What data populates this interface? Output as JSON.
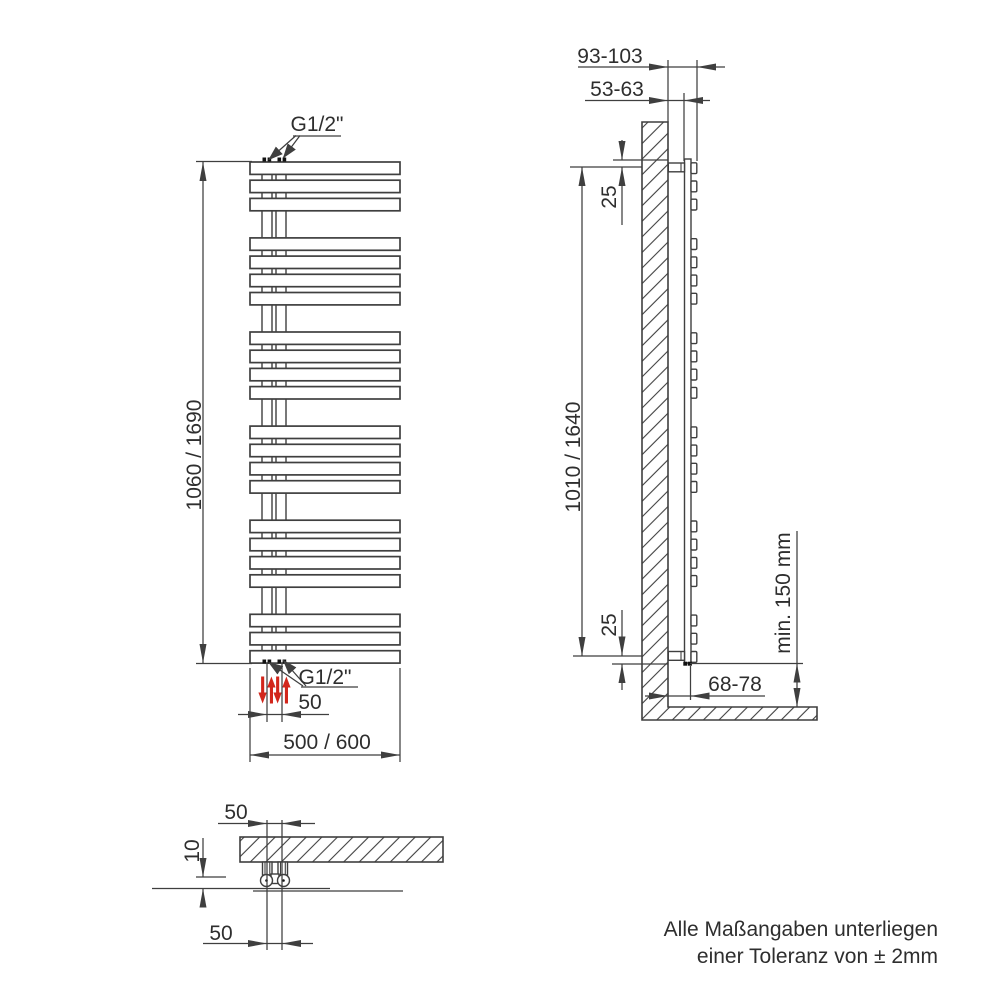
{
  "front_view": {
    "connection_top_label": "G1/2\"",
    "connection_bottom_label": "G1/2\"",
    "height_dim": "1060 / 1690",
    "connection_spacing_dim": "50",
    "width_dim": "500 / 600",
    "bar_groups": [
      3,
      4,
      4,
      4,
      4,
      3
    ]
  },
  "side_view": {
    "total_depth_dim": "93-103",
    "wall_to_tube_dim": "53-63",
    "top_offset_dim": "25",
    "bracket_distance_dim": "1010 / 1640",
    "bottom_offset_dim": "25",
    "floor_clearance_dim": "min. 150 mm",
    "valve_wall_distance_dim": "68-78"
  },
  "top_view": {
    "connection_spacing_dim_upper": "50",
    "wall_gap_dim": "10",
    "connection_spacing_dim_lower": "50"
  },
  "tolerance_note": {
    "line1": "Alle Maßangaben unterliegen",
    "line2": "einer Toleranz von ± 2mm"
  },
  "colors": {
    "line": "#3f3f3f",
    "text": "#2e2e2e",
    "flow_arrow_red": "#d2261b"
  }
}
